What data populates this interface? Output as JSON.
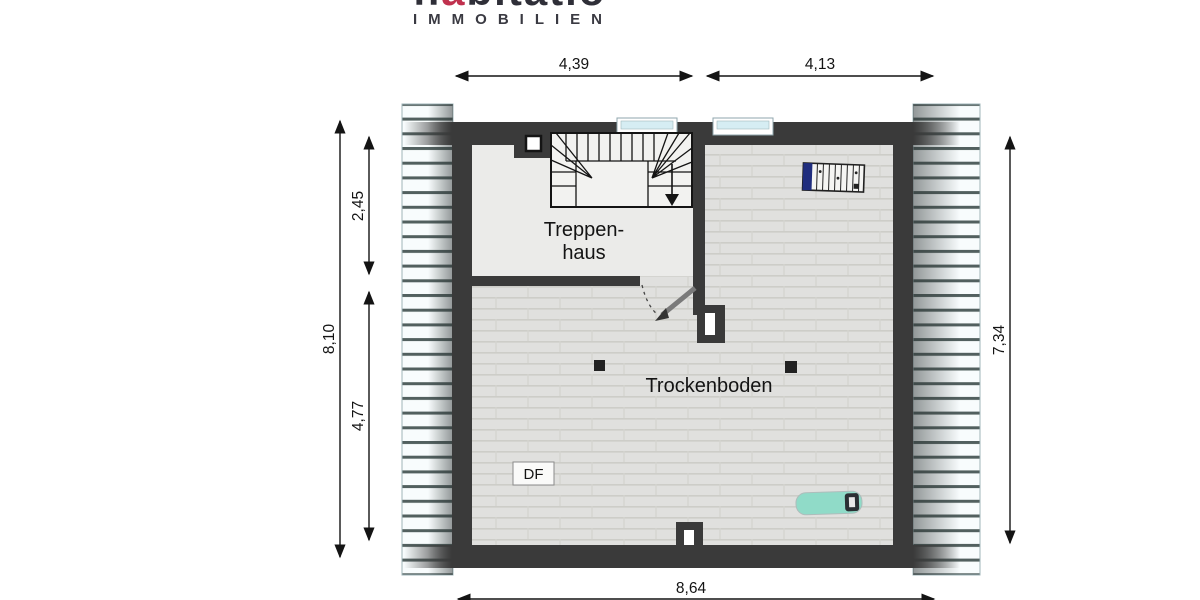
{
  "logo": {
    "brand_prefix": "h",
    "brand_accent": "a",
    "brand_suffix": "bitatio",
    "subtitle": "IMMOBILIEN"
  },
  "plan": {
    "rooms": {
      "stairwell": {
        "label_line1": "Treppen-",
        "label_line2": "haus"
      },
      "attic": {
        "label": "Trockenboden"
      }
    },
    "annotations": {
      "roof_window": "DF"
    },
    "symbols": [
      "stair-run-with-down-arrow",
      "door-swing",
      "chimney",
      "columns",
      "radiator",
      "lounger",
      "roof-hatching"
    ]
  },
  "dimensions": {
    "top_left_width": "4,39",
    "top_right_width": "4,13",
    "left_total_height": "8,10",
    "left_stairwell_height": "2,45",
    "left_attic_height": "4,77",
    "right_height": "7,34",
    "bottom_width": "8,64"
  },
  "colors": {
    "wall": "#3a3a3a",
    "brand_accent_red": "#c0314e",
    "window_glass": "#d6edf3",
    "roof_hatch_line": "#52605f",
    "stairwell_floor": "#ebebe9",
    "attic_floor": "#e0e0de",
    "lounger": "#90dbc8",
    "radiator_valve": "#1f2d7e"
  }
}
